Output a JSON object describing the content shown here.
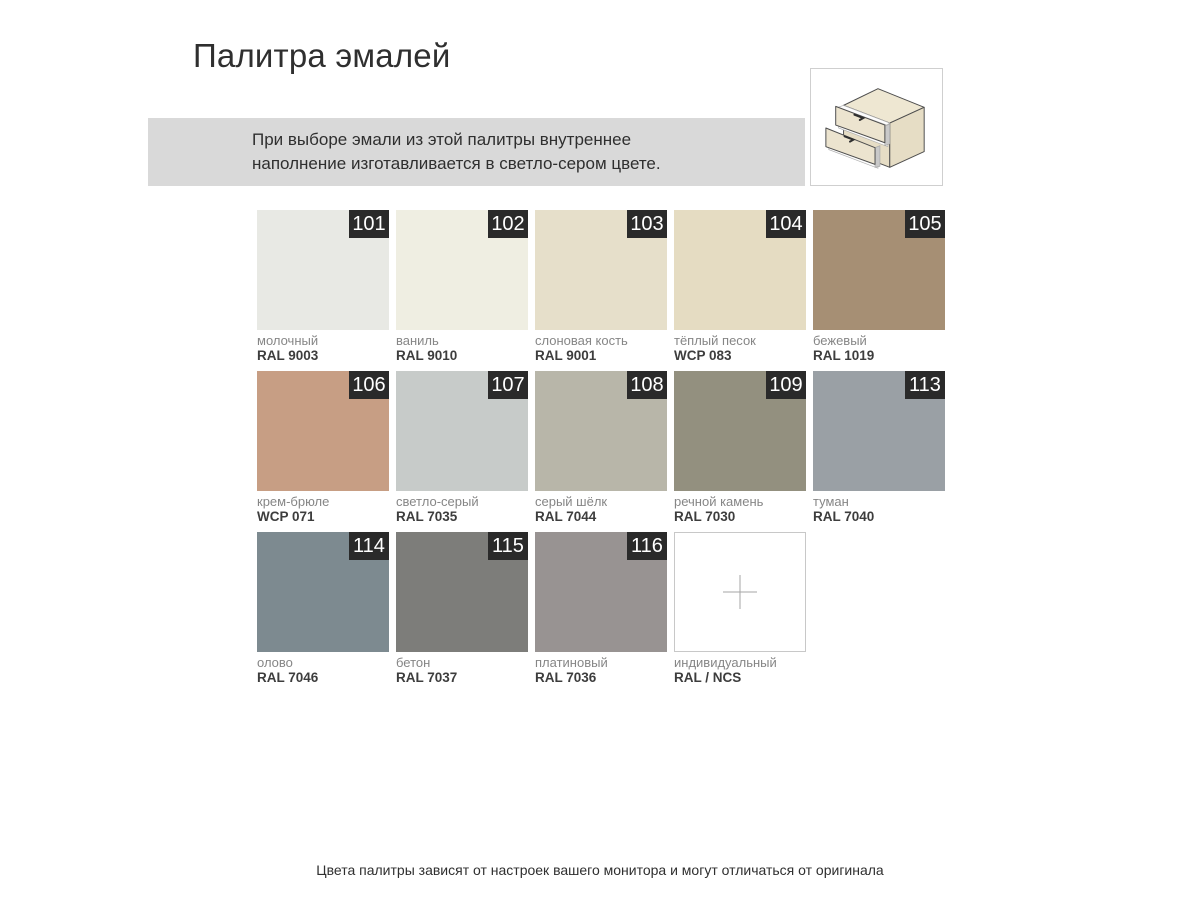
{
  "theme": {
    "page-bg": "#ffffff",
    "banner-bg": "#d9d9d9",
    "badge-bg": "#2a2a2a",
    "badge-text": "#ffffff",
    "text-primary": "#2f2f2f",
    "text-secondary": "#868686",
    "box-border": "#cfcfcf",
    "cross-color": "#a6a6a6",
    "icon-cream": "#ece4cf",
    "icon-cream-dark": "#e6ddc5",
    "icon-outline": "#4d4d4d"
  },
  "header": {
    "title": "Палитра эмалей"
  },
  "banner": {
    "line1": "При выборе эмали из этой палитры внутреннее",
    "line2": "наполнение изготавливается в светло-сером цвете."
  },
  "icons": {
    "drawer_unit": "two-drawer-cabinet-isometric",
    "custom_color": "plus-cross"
  },
  "swatches": [
    {
      "num": "101",
      "name": "молочный",
      "code": "RAL 9003",
      "hex": "#e8e9e4"
    },
    {
      "num": "102",
      "name": "ваниль",
      "code": "RAL 9010",
      "hex": "#efeee2"
    },
    {
      "num": "103",
      "name": "слоновая кость",
      "code": "RAL 9001",
      "hex": "#e6dfca"
    },
    {
      "num": "104",
      "name": "тёплый песок",
      "code": "WCP 083",
      "hex": "#e5dcc2"
    },
    {
      "num": "105",
      "name": "бежевый",
      "code": "RAL 1019",
      "hex": "#a68f74"
    },
    {
      "num": "106",
      "name": "крем-брюле",
      "code": "WCP 071",
      "hex": "#c79e84"
    },
    {
      "num": "107",
      "name": "светло-серый",
      "code": "RAL 7035",
      "hex": "#c7cbc9"
    },
    {
      "num": "108",
      "name": "серый шёлк",
      "code": "RAL 7044",
      "hex": "#b8b6a9"
    },
    {
      "num": "109",
      "name": "речной камень",
      "code": "RAL 7030",
      "hex": "#93907f"
    },
    {
      "num": "113",
      "name": "туман",
      "code": "RAL 7040",
      "hex": "#9aa0a5"
    },
    {
      "num": "114",
      "name": "олово",
      "code": "RAL 7046",
      "hex": "#7d8a90"
    },
    {
      "num": "115",
      "name": "бетон",
      "code": "RAL 7037",
      "hex": "#7d7d7a"
    },
    {
      "num": "116",
      "name": "платиновый",
      "code": "RAL 7036",
      "hex": "#989392"
    },
    {
      "num": "",
      "name": "индивидуальный",
      "code": "RAL / NCS",
      "hex": "#ffffff"
    }
  ],
  "footer": {
    "disclaimer": "Цвета палитры зависят от настроек вашего монитора и могут отличаться от оригинала"
  }
}
